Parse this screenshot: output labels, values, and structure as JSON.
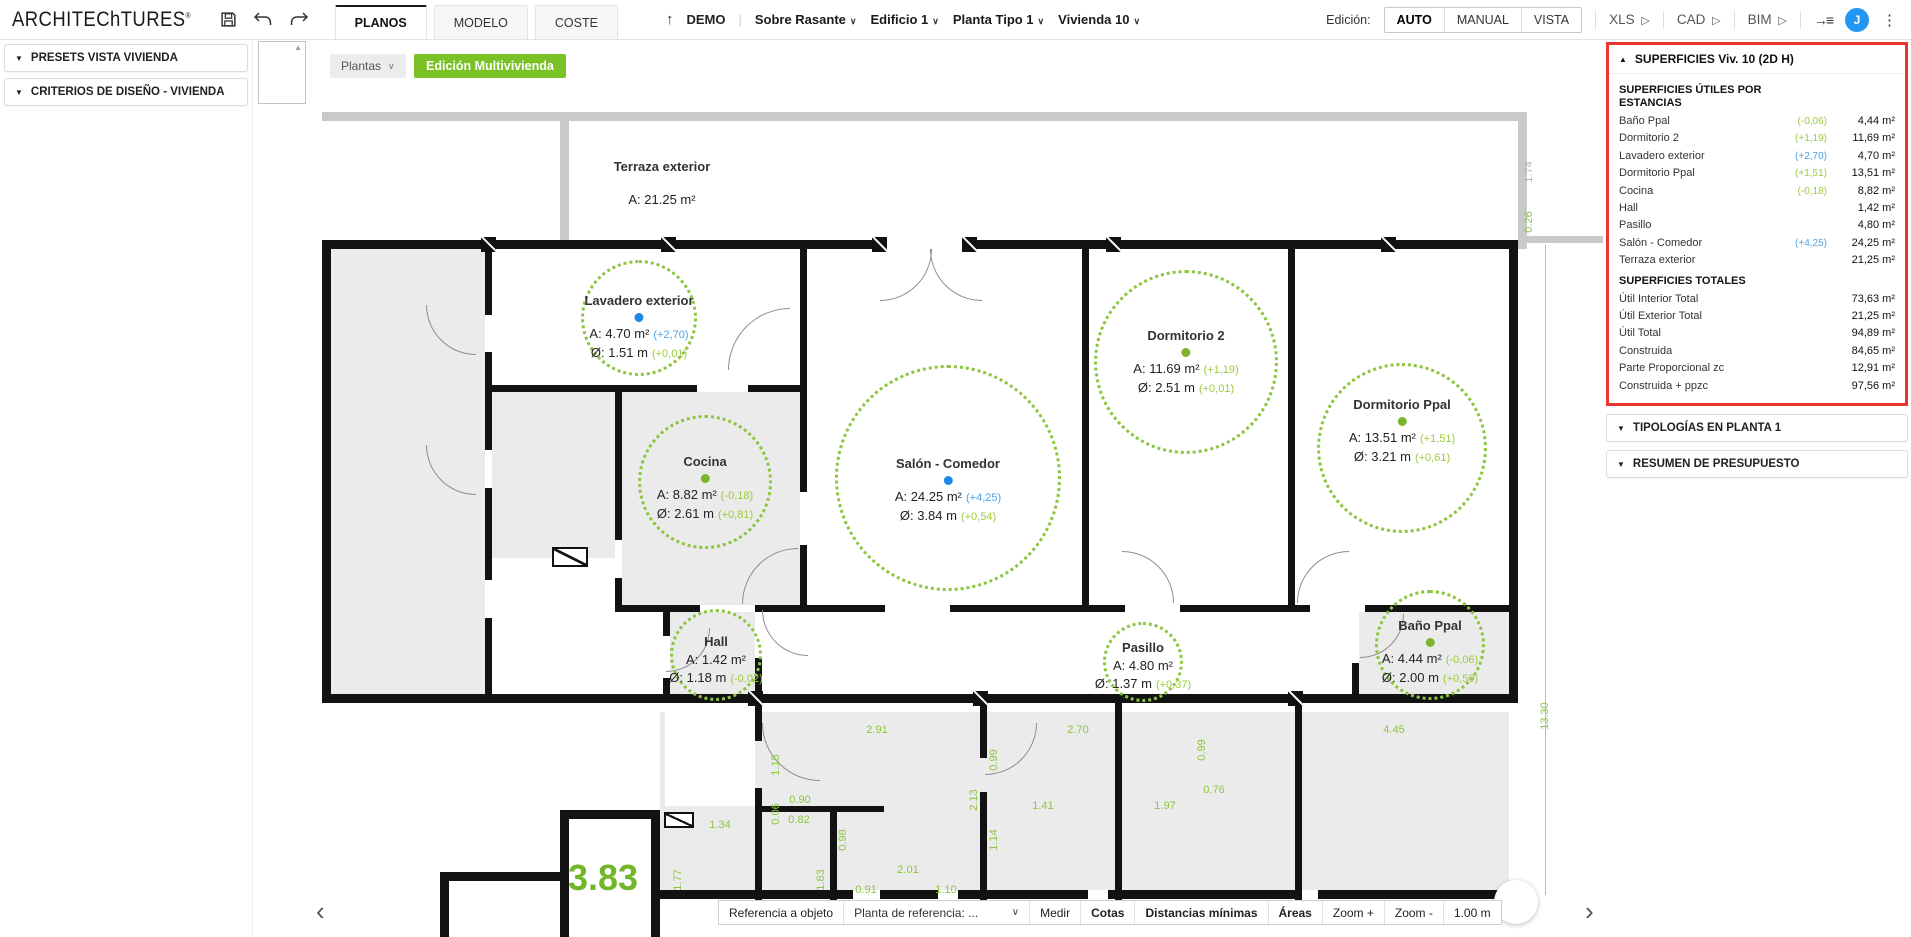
{
  "header": {
    "logo": "ARCHITEChTURES",
    "logo_reg": "®",
    "tabs": [
      {
        "id": "planos",
        "label": "PLANOS",
        "active": true
      },
      {
        "id": "modelo",
        "label": "MODELO",
        "active": false
      },
      {
        "id": "coste",
        "label": "COSTE",
        "active": false
      }
    ],
    "up_arrow": "↑",
    "demo_label": "DEMO",
    "breadcrumb": [
      "Sobre Rasante",
      "Edificio 1",
      "Planta Tipo 1",
      "Vivienda 10"
    ],
    "edicion_label": "Edición:",
    "edition_modes": [
      {
        "label": "AUTO",
        "active": true
      },
      {
        "label": "MANUAL",
        "active": false
      },
      {
        "label": "VISTA",
        "active": false
      }
    ],
    "exports": [
      "XLS",
      "CAD",
      "BIM"
    ],
    "avatar_initial": "J"
  },
  "sidebar": {
    "panels": [
      {
        "label": "PRESETS VISTA VIVIENDA"
      },
      {
        "label": "CRITERIOS DE DISEÑO - VIVIENDA"
      }
    ]
  },
  "right_panel": {
    "superficies": {
      "title": "SUPERFICIES Viv. 10 (2D H)",
      "section1_title": "SUPERFICIES ÚTILES POR ESTANCIAS",
      "rows": [
        {
          "label": "Baño Ppal",
          "delta": "(-0,06)",
          "delta_color": "green",
          "value": "4,44 m²"
        },
        {
          "label": "Dormitorio 2",
          "delta": "(+1,19)",
          "delta_color": "green",
          "value": "11,69 m²"
        },
        {
          "label": "Lavadero exterior",
          "delta": "(+2,70)",
          "delta_color": "blue",
          "value": "4,70 m²"
        },
        {
          "label": "Dormitorio Ppal",
          "delta": "(+1,51)",
          "delta_color": "green",
          "value": "13,51 m²"
        },
        {
          "label": "Cocina",
          "delta": "(-0,18)",
          "delta_color": "green",
          "value": "8,82 m²"
        },
        {
          "label": "Hall",
          "delta": "",
          "delta_color": "",
          "value": "1,42 m²"
        },
        {
          "label": "Pasillo",
          "delta": "",
          "delta_color": "",
          "value": "4,80 m²"
        },
        {
          "label": "Salón - Comedor",
          "delta": "(+4,25)",
          "delta_color": "blue",
          "value": "24,25 m²"
        },
        {
          "label": "Terraza exterior",
          "delta": "",
          "delta_color": "",
          "value": "21,25 m²"
        }
      ],
      "section2_title": "SUPERFICIES TOTALES",
      "totals": [
        {
          "label": "Útil Interior Total",
          "value": "73,63 m²"
        },
        {
          "label": "Útil Exterior Total",
          "value": "21,25 m²"
        },
        {
          "label": "Útil Total",
          "value": "94,89 m²"
        },
        {
          "label": "Construida",
          "value": "84,65 m²"
        },
        {
          "label": "Parte Proporcional zc",
          "value": "12,91 m²"
        },
        {
          "label": "Construida + ppzc",
          "value": "97,56 m²"
        }
      ]
    },
    "collapsed_panels": [
      {
        "label": "TIPOLOGÍAS EN PLANTA 1"
      },
      {
        "label": "RESUMEN DE PRESUPUESTO"
      }
    ]
  },
  "canvas": {
    "plantas_button": "Plantas",
    "badge": "Edición Multivivienda",
    "rooms": [
      {
        "name": "Terraza exterior",
        "x": 662,
        "y": 158,
        "terrace": true,
        "dot": null,
        "circle": null,
        "area": "A: 21.25 m²",
        "area_delta": "",
        "dia": "",
        "dia_delta": ""
      },
      {
        "name": "Lavadero exterior",
        "x": 639,
        "y": 292,
        "dot": "blue",
        "circle": {
          "cx": 639,
          "cy": 318,
          "r": 58
        },
        "area": "A: 4.70 m²",
        "area_delta": "(+2,70)",
        "area_delta_color": "blue",
        "dia": "Ø: 1.51 m",
        "dia_delta": "(+0,01)",
        "dia_delta_color": "green"
      },
      {
        "name": "Cocina",
        "x": 705,
        "y": 453,
        "dot": "green",
        "circle": {
          "cx": 705,
          "cy": 482,
          "r": 67
        },
        "area": "A: 8.82 m²",
        "area_delta": "(-0,18)",
        "area_delta_color": "green",
        "dia": "Ø: 2.61 m",
        "dia_delta": "(+0,81)",
        "dia_delta_color": "green"
      },
      {
        "name": "Salón - Comedor",
        "x": 948,
        "y": 455,
        "dot": "blue",
        "circle": {
          "cx": 948,
          "cy": 478,
          "r": 113
        },
        "area": "A: 24.25 m²",
        "area_delta": "(+4,25)",
        "area_delta_color": "blue",
        "dia": "Ø: 3.84 m",
        "dia_delta": "(+0,54)",
        "dia_delta_color": "green"
      },
      {
        "name": "Dormitorio 2",
        "x": 1186,
        "y": 327,
        "dot": "green",
        "circle": {
          "cx": 1186,
          "cy": 362,
          "r": 92
        },
        "area": "A: 11.69 m²",
        "area_delta": "(+1,19)",
        "area_delta_color": "green",
        "dia": "Ø: 2.51 m",
        "dia_delta": "(+0,01)",
        "dia_delta_color": "green"
      },
      {
        "name": "Dormitorio Ppal",
        "x": 1402,
        "y": 396,
        "dot": "green",
        "circle": {
          "cx": 1402,
          "cy": 448,
          "r": 85
        },
        "area": "A: 13.51 m²",
        "area_delta": "(+1,51)",
        "area_delta_color": "green",
        "dia": "Ø: 3.21 m",
        "dia_delta": "(+0,61)",
        "dia_delta_color": "green"
      },
      {
        "name": "Hall",
        "x": 716,
        "y": 633,
        "dot": null,
        "circle": {
          "cx": 716,
          "cy": 655,
          "r": 46
        },
        "area": "A: 1.42 m²",
        "area_delta": "",
        "dia": "Ø: 1.18 m",
        "dia_delta": "(-0,02)",
        "dia_delta_color": "green"
      },
      {
        "name": "Pasillo",
        "x": 1143,
        "y": 639,
        "dot": null,
        "circle": {
          "cx": 1143,
          "cy": 662,
          "r": 40
        },
        "area": "A: 4.80 m²",
        "area_delta": "",
        "dia": "Ø: 1.37 m",
        "dia_delta": "(+0,37)",
        "dia_delta_color": "green"
      },
      {
        "name": "Baño Ppal",
        "x": 1430,
        "y": 617,
        "dot": "green",
        "circle": {
          "cx": 1430,
          "cy": 645,
          "r": 55
        },
        "area": "A: 4.44 m²",
        "area_delta": "(-0,06)",
        "area_delta_color": "green",
        "dia": "Ø: 2.00 m",
        "dia_delta": "(+0,50)",
        "dia_delta_color": "green"
      }
    ],
    "dimensions": [
      {
        "t": "2.91",
        "x": 877,
        "y": 730
      },
      {
        "t": "1.15",
        "x": 776,
        "y": 765,
        "v": true
      },
      {
        "t": "0.90",
        "x": 800,
        "y": 800
      },
      {
        "t": "0.06",
        "x": 776,
        "y": 814,
        "v": true
      },
      {
        "t": "0.82",
        "x": 799,
        "y": 820
      },
      {
        "t": "1.34",
        "x": 720,
        "y": 825
      },
      {
        "t": "0.98",
        "x": 843,
        "y": 840,
        "v": true
      },
      {
        "t": "2.01",
        "x": 908,
        "y": 870
      },
      {
        "t": "0.91",
        "x": 866,
        "y": 890
      },
      {
        "t": "1.10",
        "x": 946,
        "y": 890
      },
      {
        "t": "1.83",
        "x": 821,
        "y": 880,
        "v": true
      },
      {
        "t": "1.77",
        "x": 678,
        "y": 880,
        "v": true
      },
      {
        "t": "0.99",
        "x": 994,
        "y": 760,
        "v": true
      },
      {
        "t": "2.13",
        "x": 974,
        "y": 800,
        "v": true
      },
      {
        "t": "1.14",
        "x": 994,
        "y": 840,
        "v": true
      },
      {
        "t": "0.99",
        "x": 1202,
        "y": 750,
        "v": true
      },
      {
        "t": "2.70",
        "x": 1078,
        "y": 730
      },
      {
        "t": "4.45",
        "x": 1394,
        "y": 730
      },
      {
        "t": "1.41",
        "x": 1043,
        "y": 806
      },
      {
        "t": "1.97",
        "x": 1165,
        "y": 806
      },
      {
        "t": "0.76",
        "x": 1214,
        "y": 790
      },
      {
        "t": "13.30",
        "x": 1545,
        "y": 716,
        "v": true
      },
      {
        "t": "0.26",
        "x": 1529,
        "y": 222,
        "v": true
      },
      {
        "t": "1.74",
        "x": 1529,
        "y": 172,
        "v": true,
        "gray": true
      }
    ],
    "big_dimension": {
      "t": "3.83",
      "x": 603,
      "y": 878
    },
    "toolbar": {
      "items": [
        {
          "t": "Referencia a objeto"
        },
        {
          "t": "Planta de referencia:  ...",
          "select": true
        },
        {
          "t": "Medir"
        },
        {
          "t": "Cotas",
          "b": true
        },
        {
          "t": "Distancias mínimas",
          "b": true
        },
        {
          "t": "Áreas",
          "b": true
        },
        {
          "t": "Zoom +"
        },
        {
          "t": "Zoom -"
        },
        {
          "t": "1.00 m"
        }
      ]
    },
    "nav": {
      "left_chevron": "‹",
      "right_chevron": "›"
    }
  }
}
